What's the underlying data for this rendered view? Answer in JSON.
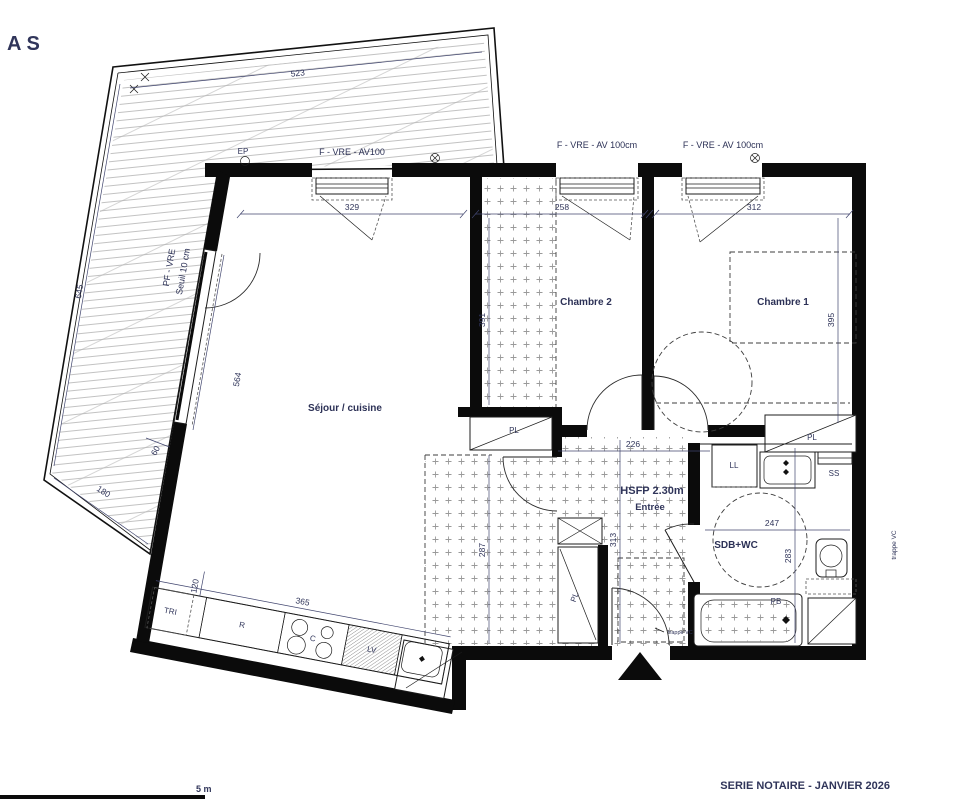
{
  "labels": {
    "corner_mark": "AS",
    "sejour": "Séjour / cuisine",
    "chambre2": "Chambre 2",
    "chambre1": "Chambre 1",
    "hsfp": "HSFP 2.30m",
    "entree": "Entrée",
    "sdb": "SDB+WC",
    "window_sejour": "F - VRE - AV100",
    "window_ch2": "F - VRE - AV 100cm",
    "window_ch1": "F - VRE - AV 100cm",
    "bay_1": "PF - VRE",
    "bay_2": "Seuil 10 cm",
    "ep": "EP",
    "pl_ch2": "PL",
    "pl_ch1": "PL",
    "pl_entree": "PL",
    "ll": "LL",
    "ss": "SS",
    "pb": "PB",
    "tri": "TRI",
    "fridge": "R",
    "cooktop": "C",
    "dishwasher": "LV",
    "trappe_side": "trappe VC",
    "trappe_entry": "trappe VC",
    "footer": "SERIE NOTAIRE - JANVIER 2026",
    "scale": "5 m"
  },
  "dims": {
    "terrace_top": "523",
    "terrace_left": "645",
    "terrace_bottom": "180",
    "terrace_wall": "60",
    "sejour_width": "329",
    "ch2_width": "258",
    "ch1_width": "312",
    "ch2_depth": "391",
    "ch1_depth": "395",
    "entree_width": "226",
    "sejour_depth": "287",
    "entree_depth": "313",
    "sdb_width": "247",
    "sdb_depth": "283",
    "bay": "564",
    "kitchen_len": "365",
    "kitchen_depth": "120"
  },
  "colors": {
    "wall": "#0b0b0b",
    "label_text": "#2c3156",
    "stipple": "#9a9a9a",
    "deck_line": "#a8a8a8"
  }
}
